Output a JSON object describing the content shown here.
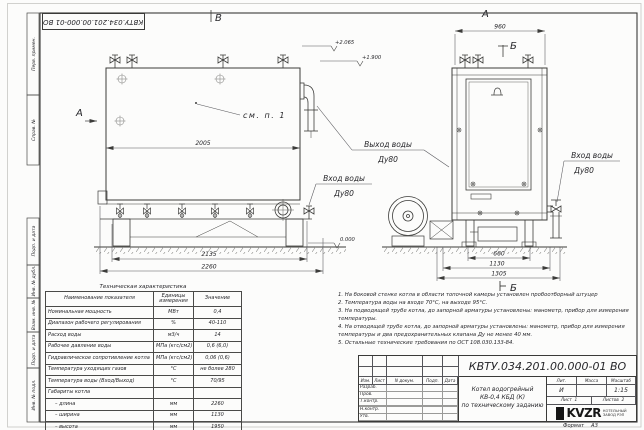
{
  "sheet": {
    "doc_number": "КВТУ.034.201.00.000-01 ВО",
    "format_label": "Формат",
    "format_value": "А3"
  },
  "margin_labels": [
    "Перв. примен.",
    "Справ. №",
    "Подп. и дата",
    "Инв. № дубл.",
    "Взам. инв. №",
    "Подп. и дата",
    "Инв. № подл."
  ],
  "drawing": {
    "view_b_label": "В",
    "section_a_label": "А",
    "front_view_label": "А",
    "section_b_mark": "Б",
    "section_b_view": "Б",
    "callout_see_item": "см. п. 1",
    "outlet_line1": "Выход воды",
    "outlet_line2": "Ду80",
    "inlet_line1": "Вход воды",
    "inlet_line2": "Ду80",
    "inlet_right_line1": "Вход воды",
    "inlet_right_line2": "Ду80",
    "elev_top": "+2.065",
    "elev_mid": "+1.900",
    "elev_zero": "0.000",
    "dim_2005": "2005",
    "dim_2135": "2135",
    "dim_2260": "2260",
    "dim_960": "960",
    "dim_660": "660",
    "dim_1130": "1130",
    "dim_1305": "1305"
  },
  "spec_table": {
    "title": "Техническая характеристика",
    "headers": [
      "Наименование показателя",
      "Единицы измерения",
      "Значение"
    ],
    "rows": [
      [
        "Номинальная мощность",
        "МВт",
        "0,4"
      ],
      [
        "Диапазон рабочего регулирования",
        "%",
        "40-110"
      ],
      [
        "Расход воды",
        "м3/ч",
        "14"
      ],
      [
        "Рабочее давление воды",
        "МПа (кгс/см2)",
        "0,6 (6,0)"
      ],
      [
        "Гидравлическое сопротивление котла",
        "МПа (кгс/см2)",
        "0,06 (0,6)"
      ],
      [
        "Температура уходящих газов",
        "°С",
        "не более 280"
      ],
      [
        "Температура воды (Вход/Выход)",
        "°С",
        "70/95"
      ],
      [
        "Габариты котла",
        "",
        ""
      ],
      [
        "– длина",
        "мм",
        "2260"
      ],
      [
        "– ширина",
        "мм",
        "1130"
      ],
      [
        "– высота",
        "мм",
        "1950"
      ]
    ]
  },
  "notes": [
    "1.  На боковой стенке котла в области топочной камеры установлен пробоотборный штуцер",
    "2.  Температура воды на входе 70°С, на выходе 95°С.",
    "3.  На подводящей трубе котла, до запорной арматуры установлены: манометр, прибор для измерения температуры.",
    "4.  На отводящей трубе котла, до запорной арматуры установлены: манометр, прибор для измерения температуры и два предохранительных клапана Ду не менее 40 мм.",
    "5.  Остальные технические требования по ОСТ 108.030.133-84."
  ],
  "title_block": {
    "doc_number": "КВТУ.034.201.00.000-01 ВО",
    "header_cols": [
      "Изм.",
      "Лист",
      "N докум.",
      "Подп.",
      "Дата"
    ],
    "row_labels": [
      "Разраб.",
      "Пров.",
      "Т.контр.",
      "",
      "Н.контр.",
      "Утв."
    ],
    "product_title_lines": [
      "Котел водогрейный",
      "КВ-0,4  КБД  (К)",
      "по техническому заданию"
    ],
    "lit_header": "Лит.",
    "mass_header": "Масса",
    "scale_header": "Масштаб",
    "lit_value": "И",
    "mass_value": "",
    "scale_value": "1:15",
    "sheet_label": "Лист",
    "sheet_value": "1",
    "sheets_label": "Листов",
    "sheets_value": "2",
    "logo_text": "KVZR",
    "logo_caption_1": "КОТЕЛЬНЫЙ",
    "logo_caption_2": "ЗАВОД РЭП"
  }
}
